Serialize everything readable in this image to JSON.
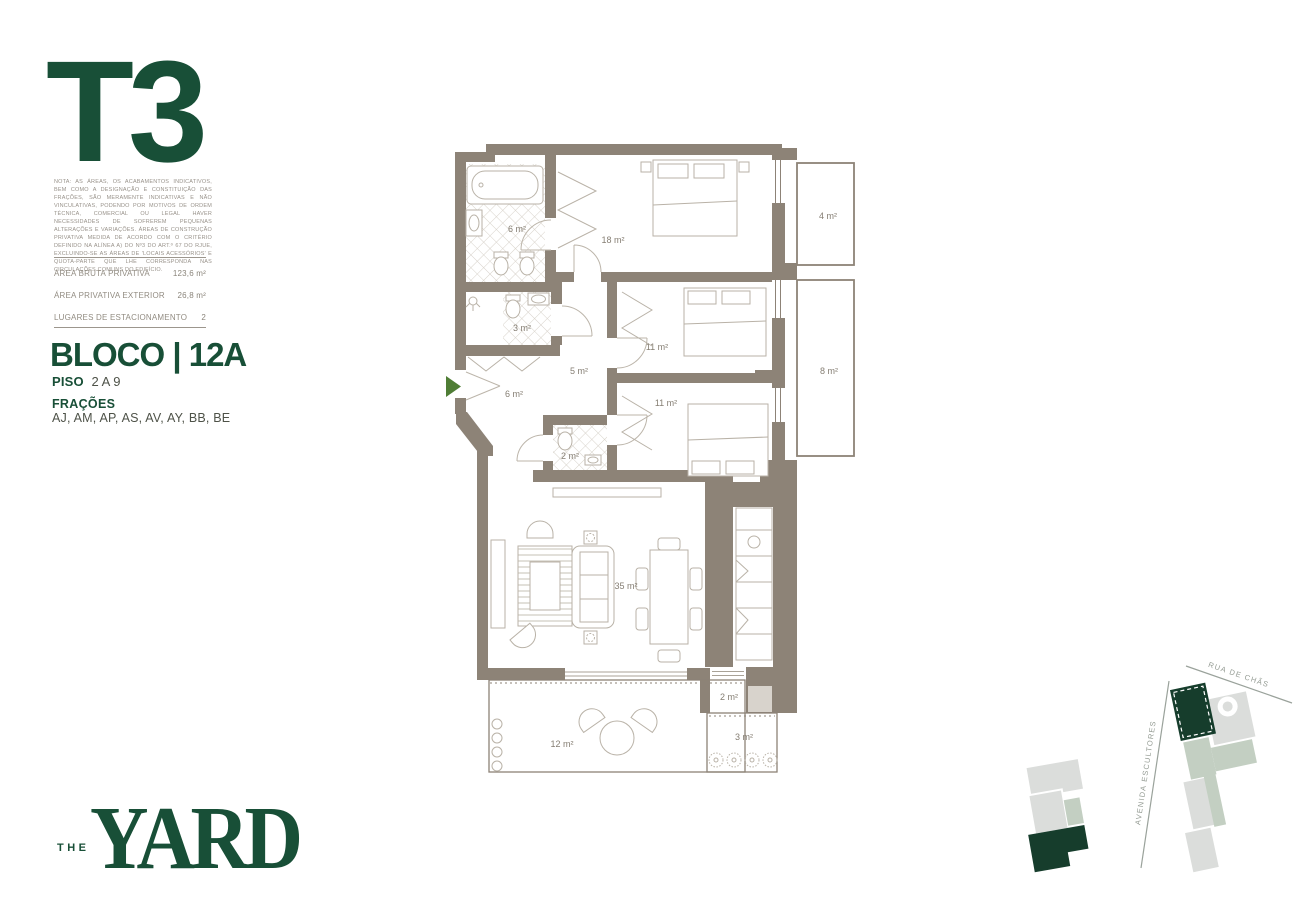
{
  "left_panel": {
    "type_title": "T3",
    "disclaimer": "NOTA: AS ÁREAS, OS ACABAMENTOS INDICATIVOS, BEM COMO A DESIGNAÇÃO E CONSTITUIÇÃO DAS FRAÇÕES, SÃO MERAMENTE INDICATIVAS E NÃO VINCULATIVAS, PODENDO POR MOTIVOS DE ORDEM TÉCNICA, COMERCIAL OU LEGAL HAVER NECESSIDADES DE SOFREREM PEQUENAS ALTERAÇÕES E VARIAÇÕES. ÁREAS DE CONSTRUÇÃO PRIVATIVA MEDIDA DE ACORDO COM O CRITÉRIO DEFINIDO NA ALÍNEA A) DO Nº3 DO ART.º 67 DO RJUE, EXCLUINDO-SE AS ÁREAS DE 'LOCAIS ACESSÓRIOS' E QUOTA-PARTE QUE LHE CORRESPONDA NAS CIRCULAÇÕES COMUNS DO EDIFÍCIO.",
    "areas": [
      {
        "label": "ÁREA BRUTA PRIVATIVA",
        "value": "123,6 m²"
      },
      {
        "label": "ÁREA PRIVATIVA EXTERIOR",
        "value": "26,8 m²"
      },
      {
        "label": "LUGARES DE ESTACIONAMENTO",
        "value": "2"
      }
    ],
    "bloco": "BLOCO | 12A",
    "piso": {
      "label": "PISO",
      "value": "2 A 9"
    },
    "fracoes": {
      "label": "FRAÇÕES",
      "value": "AJ, AM, AP, AS, AV, AY, BB, BE"
    }
  },
  "floorplan": {
    "rooms": [
      {
        "name": "bathroom-1",
        "area": "6 m²"
      },
      {
        "name": "bedroom-1",
        "area": "18 m²"
      },
      {
        "name": "balcony-1",
        "area": "4 m²"
      },
      {
        "name": "bathroom-2",
        "area": "3 m²"
      },
      {
        "name": "hall",
        "area": "5 m²"
      },
      {
        "name": "entry",
        "area": "6 m²"
      },
      {
        "name": "bedroom-2",
        "area": "11 m²"
      },
      {
        "name": "bedroom-3",
        "area": "11 m²"
      },
      {
        "name": "balcony-2",
        "area": "8 m²"
      },
      {
        "name": "wc",
        "area": "2 m²"
      },
      {
        "name": "living-room",
        "area": "35 m²"
      },
      {
        "name": "storage",
        "area": "2 m²"
      },
      {
        "name": "terrace-1",
        "area": "12 m²"
      },
      {
        "name": "terrace-2",
        "area": "3 m²"
      }
    ]
  },
  "site_map": {
    "streets": [
      {
        "name": "RUA DE CHÃS"
      },
      {
        "name": "AVENIDA ESCULTORES"
      }
    ]
  },
  "brand": {
    "prefix": "THE",
    "name": "YARD"
  },
  "colors": {
    "brand_green": "#184f37",
    "map_green": "#163d2c",
    "wall": "#8d8377",
    "entrance_arrow": "#4f7d35"
  }
}
